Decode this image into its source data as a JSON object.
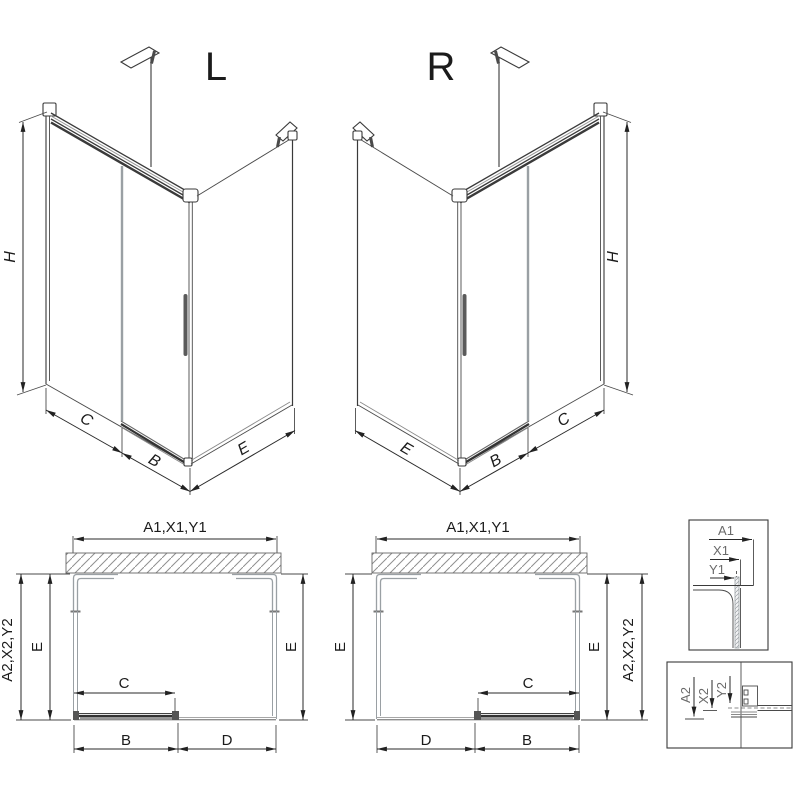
{
  "title": "Shower enclosure technical drawing, L and R versions",
  "colors": {
    "line": "#3a3a3a",
    "glass_edge": "#9aa0a4",
    "hatch": "#8f8f8f",
    "text": "#1b1b1b",
    "background": "#ffffff"
  },
  "iso_left": {
    "label": "L",
    "dim_height": "H",
    "dim_fixed": "C",
    "dim_door": "B",
    "dim_side": "E"
  },
  "iso_right": {
    "label": "R",
    "dim_height": "H",
    "dim_fixed": "C",
    "dim_door": "B",
    "dim_side": "E"
  },
  "plan_left": {
    "dim_top": "A1,X1,Y1",
    "dim_outer": "A2,X2,Y2",
    "dim_side_left": "E",
    "dim_side_right": "E",
    "dim_door": "C",
    "dim_bottom_left": "B",
    "dim_bottom_right": "D"
  },
  "plan_right": {
    "dim_top": "A1,X1,Y1",
    "dim_outer": "A2,X2,Y2",
    "dim_side_left": "E",
    "dim_side_right": "E",
    "dim_door": "C",
    "dim_bottom_left": "D",
    "dim_bottom_right": "B"
  },
  "detail_top": {
    "dim_1": "A1",
    "dim_2": "X1",
    "dim_3": "Y1"
  },
  "detail_bottom": {
    "dim_1": "A2",
    "dim_2": "X2",
    "dim_3": "Y2"
  }
}
